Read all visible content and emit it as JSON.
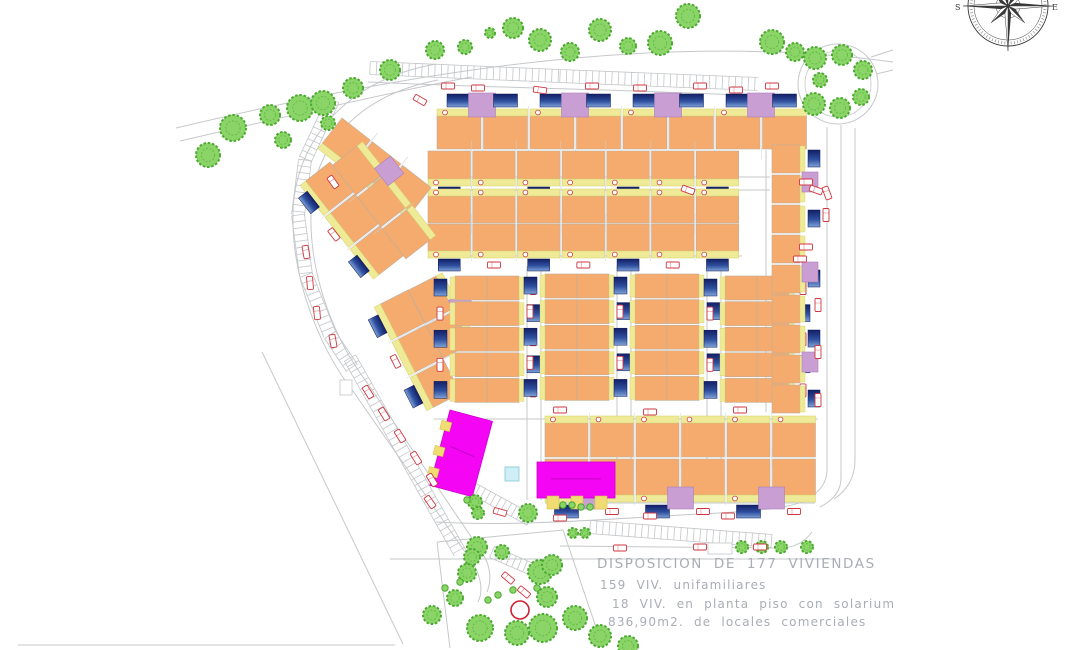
{
  "annotation": {
    "line1": "DISPOSICION DE 177 VIVIENDAS",
    "line2": "159 VIV. unifamiliares",
    "line3": "18 VIV. en planta piso con solarium",
    "line4": "836,90m2. de locales comerciales"
  },
  "compass": {
    "left": "S",
    "right": "E"
  },
  "palette": {
    "house": "#f5ab6e",
    "houseStroke": "#bfae9a",
    "terrace": "#eeea97",
    "terraceStroke": "#d6d066",
    "poolTop": "#131f66",
    "poolMid": "#2e4f9e",
    "poolLow": "#7fa2d8",
    "lavender": "#c99fd3",
    "lavenderStroke": "#aa7fba",
    "magenta": "#f405f4",
    "magentaStroke": "#cf00cf",
    "magentaText": "#b800b8",
    "red": "#cf3740",
    "treeFill": "#8bd568",
    "treeStroke": "#4aa92e",
    "treeInner": "#5cb93e",
    "road": "#c5c8ca",
    "ladder": "#c3c6c9",
    "cyan": "#cfeef5",
    "cyanStroke": "#84c8d8",
    "dark": "#3a3a3a",
    "annText": "#a9adb4",
    "stub": "#f0dc72",
    "stubStroke": "#d6c24e"
  },
  "roundabout": {
    "cx": 838,
    "cy": 84,
    "rOuter": 40,
    "rInner": 33
  },
  "compassGeom": {
    "cx": 1008,
    "cy": 6,
    "rOuter": 40,
    "rMid": 34,
    "rTick": 37,
    "longPt": 45,
    "shortPt": 24
  },
  "redCircle": [
    520,
    610,
    9
  ],
  "cyanBoxes": [
    [
      505,
      467,
      14,
      14
    ]
  ],
  "rectOutlines": [
    [
      708,
      543,
      24,
      11
    ],
    [
      340,
      380,
      12,
      15
    ]
  ],
  "roads": [
    "M176,128 C380,80 640,28 893,62",
    "M180,141 C340,104 430,84 472,77",
    "M436,64 C345,80 295,142 293,212 C291,282 322,352 355,394 L472,562 C480,574 484,590 478,602",
    "M438,80 C355,96 313,148 311,212 C309,278 336,342 368,384 L484,556 C490,566 492,580 487,592",
    "M262,352 L403,644",
    "M18,645 L395,645",
    "M827,127 L827,470 C827,482 820,492 808,498",
    "M841,125 L841,478 C841,490 834,500 820,507",
    "M855,128 L855,460 C855,476 848,490 834,499",
    "M871,57 L893,50",
    "M876,74 L893,70",
    "M436,522 C520,527 620,518 700,514 C760,511 795,508 814,497",
    "M560,546 L775,548 C792,549 804,543 812,532",
    "M390,559 L836,559",
    "M437,542 L563,530 L603,648",
    "M437,542 L450,648",
    "M368,82 C500,88 640,90 762,96",
    "M527,266 L527,500",
    "M541,266 L541,500",
    "M617,266 L617,502",
    "M631,266 L631,502",
    "M707,266 L707,495",
    "M721,266 L721,495",
    "M766,150 L766,412",
    "M428,177 L770,177",
    "M428,190 L770,190",
    "M430,256 L742,256",
    "M434,419 L818,419",
    "M545,503 L815,503"
  ],
  "ladders": [
    {
      "pts": [
        [
          370,
          68
        ],
        [
          560,
          76
        ],
        [
          758,
          84
        ]
      ],
      "w": 13,
      "step": 6.5
    },
    {
      "pts": [
        [
          333,
          100
        ],
        [
          305,
          160
        ],
        [
          298,
          215
        ],
        [
          306,
          275
        ],
        [
          330,
          335
        ],
        [
          352,
          368
        ]
      ],
      "w": 13,
      "step": 6.5
    },
    {
      "pts": [
        [
          350,
          358
        ],
        [
          460,
          553
        ]
      ],
      "w": 13,
      "step": 6.5
    },
    {
      "pts": [
        [
          472,
          488
        ],
        [
          530,
          520
        ]
      ],
      "w": 12,
      "step": 6
    },
    {
      "pts": [
        [
          492,
          552
        ],
        [
          552,
          578
        ]
      ],
      "w": 12,
      "step": 6
    },
    {
      "pts": [
        [
          590,
          527
        ],
        [
          772,
          541
        ]
      ],
      "w": 13,
      "step": 6.5
    }
  ],
  "rows": [
    {
      "x": 437,
      "y": 116,
      "angle": 0,
      "units": 8,
      "uw": 44,
      "uh": 33,
      "gap": 2.5,
      "yellow": "top",
      "porch": true,
      "street": {
        "dy": -22,
        "alt": false,
        "pw": 24,
        "ph": 13
      },
      "lav": {
        "every": 2,
        "offset": 1,
        "dx": -15,
        "dy": -23,
        "w": 27,
        "h": 24
      }
    },
    {
      "x": 428,
      "y": 151,
      "angle": 0,
      "units": 7,
      "uw": 42.5,
      "uh": 28,
      "gap": 2.2,
      "yellow": "bottom",
      "porch": true,
      "street": {
        "dy": 36,
        "alt": true,
        "pw": 22,
        "ph": 12
      }
    },
    {
      "x": 428,
      "y": 196,
      "angle": 0,
      "units": 7,
      "uw": 42.5,
      "uh": 27,
      "gap": 2.2,
      "yellow": "top",
      "porch": true
    },
    {
      "x": 428,
      "y": 224,
      "angle": 0,
      "units": 7,
      "uw": 42.5,
      "uh": 27,
      "gap": 2.2,
      "yellow": "bottom",
      "porch": true,
      "street": {
        "dy": 35,
        "alt": true,
        "pw": 22,
        "ph": 12
      }
    },
    {
      "x": 545,
      "y": 423,
      "angle": 0,
      "units": 6,
      "uw": 43,
      "uh": 34,
      "gap": 2.5,
      "yellow": "top",
      "porch": true
    },
    {
      "x": 545,
      "y": 459,
      "angle": 0,
      "units": 6,
      "uw": 43,
      "uh": 36,
      "gap": 2.5,
      "yellow": "bottom",
      "porch": true,
      "street": {
        "dy": 46,
        "alt": true,
        "pw": 24,
        "ph": 13
      },
      "lav": {
        "every": 2,
        "offset": 1,
        "dx": -14,
        "dy": 28,
        "w": 26,
        "h": 22
      }
    },
    {
      "x": 342,
      "y": 118,
      "angle": 38,
      "units": 3,
      "uw": 36,
      "uh": 32,
      "gap": 2.5,
      "yellow": "bottom"
    },
    {
      "x": 330,
      "y": 162,
      "angle": 52,
      "units": 3,
      "uw": 38,
      "uh": 31,
      "gap": 2.5,
      "yellow": "bottom",
      "street": {
        "dy": 36,
        "alt": true,
        "pw": 20,
        "ph": 11
      }
    },
    {
      "x": 357,
      "y": 146,
      "angle": 52,
      "units": 3,
      "uw": 38,
      "uh": 31,
      "gap": 2.5,
      "yellow": "top",
      "lav": {
        "every": 3,
        "offset": 1,
        "dx": -12,
        "dy": -20,
        "w": 22,
        "h": 20
      }
    },
    {
      "x": 408,
      "y": 290,
      "angle": 63,
      "units": 3,
      "uw": 37,
      "uh": 31,
      "gap": 2.5,
      "yellow": "bottom",
      "street": {
        "dy": 38,
        "alt": true,
        "pw": 20,
        "ph": 11
      }
    },
    {
      "x": 436,
      "y": 276,
      "angle": 63,
      "units": 2,
      "uw": 37,
      "uh": 31,
      "gap": 2.5,
      "yellow": "top",
      "lav": {
        "every": 2,
        "offset": 1,
        "dx": -12,
        "dy": -20,
        "w": 22,
        "h": 20
      }
    }
  ],
  "strips": [
    {
      "x": 455,
      "y": 276,
      "units": 5,
      "uw": 32,
      "uh": 24,
      "gapy": 1.6
    },
    {
      "x": 545,
      "y": 274,
      "units": 5,
      "uw": 32,
      "uh": 24,
      "gapy": 1.6
    },
    {
      "x": 635,
      "y": 274,
      "units": 5,
      "uw": 32,
      "uh": 24,
      "gapy": 1.6
    },
    {
      "x": 725,
      "y": 276,
      "units": 5,
      "uw": 32,
      "uh": 24,
      "gapy": 1.6
    }
  ],
  "rightColumn": {
    "x": 772,
    "y": 145,
    "units": 9,
    "uw": 28,
    "uh": 28,
    "gapy": 2
  },
  "commercial": [
    {
      "x": 450,
      "y": 410,
      "w": 44,
      "h": 78,
      "angle": 15,
      "stubs": "left"
    },
    {
      "x": 537,
      "y": 462,
      "w": 78,
      "h": 36,
      "angle": 0,
      "stubs": "bottom"
    }
  ],
  "trees": [
    [
      208,
      155,
      12
    ],
    [
      233,
      128,
      13
    ],
    [
      270,
      115,
      10
    ],
    [
      283,
      140,
      8
    ],
    [
      300,
      108,
      13
    ],
    [
      323,
      103,
      12
    ],
    [
      328,
      123,
      7
    ],
    [
      353,
      88,
      10
    ],
    [
      390,
      70,
      10
    ],
    [
      435,
      50,
      9
    ],
    [
      465,
      47,
      7
    ],
    [
      490,
      33,
      5
    ],
    [
      513,
      28,
      10
    ],
    [
      540,
      40,
      11
    ],
    [
      570,
      52,
      9
    ],
    [
      600,
      30,
      11
    ],
    [
      628,
      46,
      8
    ],
    [
      660,
      43,
      12
    ],
    [
      688,
      16,
      12
    ],
    [
      772,
      42,
      12
    ],
    [
      795,
      52,
      9
    ],
    [
      815,
      58,
      11
    ],
    [
      842,
      55,
      10
    ],
    [
      863,
      70,
      9
    ],
    [
      820,
      80,
      7
    ],
    [
      814,
      104,
      11
    ],
    [
      840,
      108,
      10
    ],
    [
      861,
      97,
      8
    ],
    [
      477,
      547,
      10
    ],
    [
      472,
      557,
      8
    ],
    [
      502,
      552,
      7
    ],
    [
      467,
      573,
      9
    ],
    [
      540,
      572,
      12
    ],
    [
      547,
      597,
      10
    ],
    [
      543,
      628,
      14
    ],
    [
      480,
      628,
      13
    ],
    [
      517,
      633,
      12
    ],
    [
      552,
      565,
      10
    ],
    [
      575,
      618,
      12
    ],
    [
      600,
      636,
      11
    ],
    [
      628,
      646,
      10
    ],
    [
      432,
      615,
      9
    ],
    [
      455,
      598,
      8
    ],
    [
      475,
      502,
      7
    ],
    [
      478,
      513,
      6
    ],
    [
      528,
      513,
      9
    ],
    [
      742,
      547,
      6
    ],
    [
      762,
      547,
      6
    ],
    [
      781,
      547,
      6
    ],
    [
      807,
      547,
      6
    ],
    [
      573,
      533,
      5
    ],
    [
      585,
      533,
      5
    ]
  ],
  "treeDots": [
    [
      488,
      600
    ],
    [
      498,
      595
    ],
    [
      513,
      590
    ],
    [
      537,
      588
    ],
    [
      467,
      500
    ],
    [
      563,
      505
    ],
    [
      572,
      505
    ],
    [
      581,
      507
    ],
    [
      590,
      507
    ],
    [
      445,
      588
    ],
    [
      460,
      582
    ]
  ],
  "markers": [
    [
      448,
      86,
      0
    ],
    [
      478,
      88,
      0
    ],
    [
      540,
      90,
      8
    ],
    [
      592,
      86,
      0
    ],
    [
      640,
      88,
      0
    ],
    [
      700,
      86,
      0
    ],
    [
      736,
      90,
      0
    ],
    [
      772,
      86,
      0
    ],
    [
      806,
      182,
      0
    ],
    [
      816,
      190,
      20
    ],
    [
      827,
      193,
      70
    ],
    [
      826,
      215,
      90
    ],
    [
      806,
      247,
      0
    ],
    [
      800,
      259,
      0
    ],
    [
      818,
      305,
      90
    ],
    [
      818,
      352,
      90
    ],
    [
      818,
      400,
      90
    ],
    [
      306,
      252,
      80
    ],
    [
      310,
      283,
      85
    ],
    [
      317,
      313,
      85
    ],
    [
      333,
      341,
      80
    ],
    [
      333,
      182,
      55
    ],
    [
      368,
      392,
      58
    ],
    [
      384,
      414,
      58
    ],
    [
      400,
      436,
      58
    ],
    [
      416,
      458,
      58
    ],
    [
      432,
      480,
      58
    ],
    [
      500,
      512,
      15
    ],
    [
      560,
      518,
      0
    ],
    [
      620,
      548,
      0
    ],
    [
      650,
      516,
      0
    ],
    [
      700,
      547,
      0
    ],
    [
      728,
      516,
      0
    ],
    [
      760,
      547,
      0
    ],
    [
      508,
      578,
      40
    ],
    [
      524,
      592,
      40
    ],
    [
      688,
      190,
      20
    ],
    [
      430,
      502,
      55
    ],
    [
      560,
      410,
      0
    ],
    [
      650,
      412,
      0
    ],
    [
      740,
      410,
      0
    ],
    [
      420,
      100,
      30
    ]
  ]
}
